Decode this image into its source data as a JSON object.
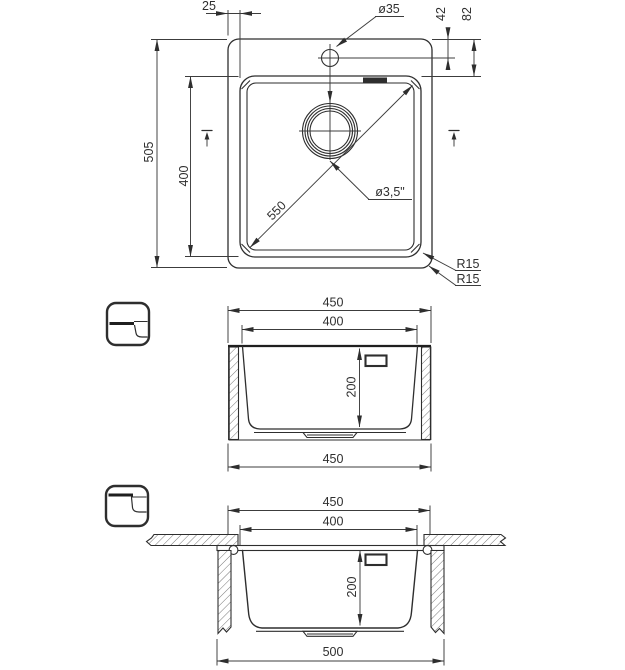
{
  "drawing": {
    "background": "#ffffff",
    "line_color": "#2e2e2e",
    "top_view": {
      "dim_rim_offset": "25",
      "dim_faucet_hole": "ø35",
      "dim_faucet_from_edge": "42",
      "dim_bowl_from_edge": "82",
      "dim_overall_depth": "505",
      "dim_bowl_depth": "400",
      "dim_diagonal": "550",
      "dim_drain": "ø3,5\"",
      "dim_corner_radius_1": "R15",
      "dim_corner_radius_2": "R15"
    },
    "section_flush": {
      "dim_overall_width": "450",
      "dim_bowl_width": "400",
      "dim_bowl_height": "200",
      "dim_bottom_width": "450"
    },
    "section_undermount": {
      "dim_overall_width": "450",
      "dim_bowl_width": "400",
      "dim_bowl_height": "200",
      "dim_flange_width": "500"
    }
  }
}
